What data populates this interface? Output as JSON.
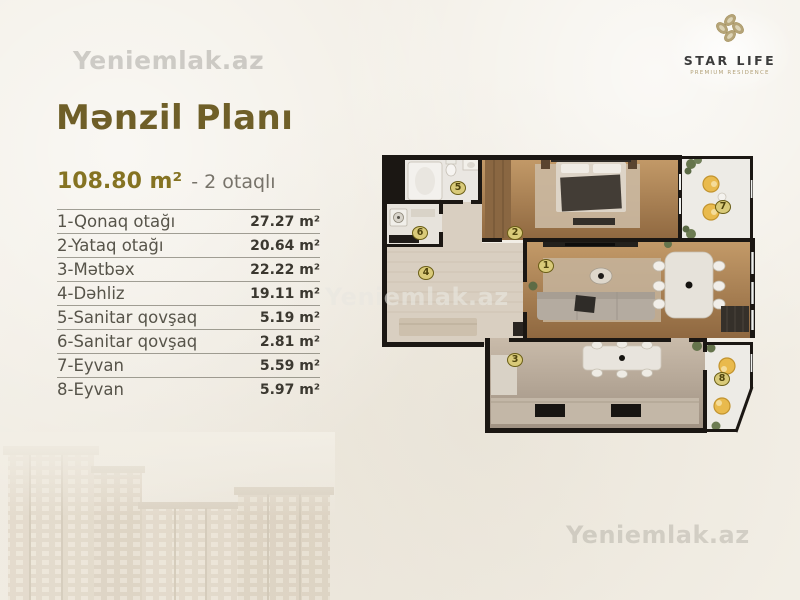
{
  "watermarks": {
    "top_left": "Yeniemlak.az",
    "middle": "Yeniemlak.az",
    "bottom_right": "Yeniemlak.az"
  },
  "logo": {
    "name": "STAR LIFE",
    "tagline": "PREMIUM RESIDENCE"
  },
  "header": {
    "title": "Mənzil Planı",
    "total_area": "108.80 m²",
    "rooms_count": "- 2 otaqlı"
  },
  "room_table": {
    "rows": [
      {
        "label": "1-Qonaq otağı",
        "area": "27.27 m²"
      },
      {
        "label": "2-Yataq otağı",
        "area": "20.64 m²"
      },
      {
        "label": "3-Mətbəx",
        "area": "22.22 m²"
      },
      {
        "label": "4-Dəhliz",
        "area": "19.11 m²"
      },
      {
        "label": "5-Sanitar qovşaq",
        "area": "5.19 m²"
      },
      {
        "label": "6-Sanitar qovşaq",
        "area": "2.81 m²"
      },
      {
        "label": "7-Eyvan",
        "area": "5.59 m²"
      },
      {
        "label": "8-Eyvan",
        "area": "5.97 m²"
      }
    ]
  },
  "floor_plan": {
    "markers": [
      {
        "n": "1",
        "x": 546,
        "y": 266
      },
      {
        "n": "2",
        "x": 515,
        "y": 233
      },
      {
        "n": "3",
        "x": 515,
        "y": 360
      },
      {
        "n": "4",
        "x": 426,
        "y": 273
      },
      {
        "n": "5",
        "x": 458,
        "y": 188
      },
      {
        "n": "6",
        "x": 420,
        "y": 233
      },
      {
        "n": "7",
        "x": 723,
        "y": 207
      },
      {
        "n": "8",
        "x": 722,
        "y": 379
      }
    ]
  },
  "colors": {
    "title_gold": "#6f5f28",
    "accent_olive": "#857322",
    "wall_black": "#1b1713",
    "marker_fill": "#d9ca79",
    "marker_border": "#6a5e16",
    "balcony_chair_yellow": "#e9ba4d"
  }
}
